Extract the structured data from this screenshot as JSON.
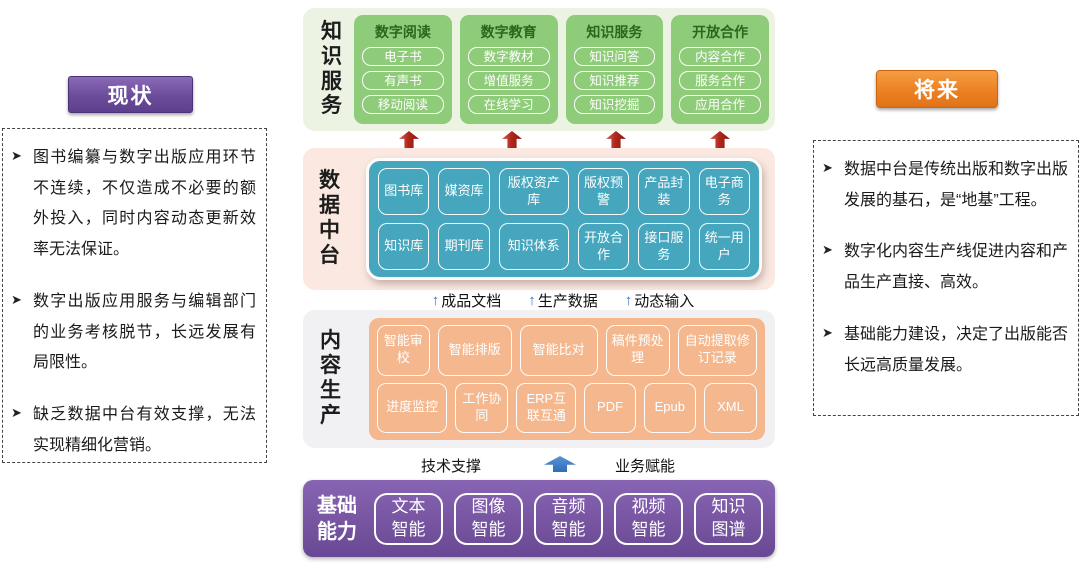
{
  "left_panel": {
    "title": "现状",
    "bullets": [
      {
        "marker": "➤",
        "text": "图书编纂与数字出版应用环节不连续，不仅造成不必要的额外投入，同时内容动态更新效率无法保证。"
      },
      {
        "marker": "➤",
        "text": "数字出版应用服务与编辑部门的业务考核脱节，长远发展有局限性。"
      },
      {
        "marker": "➤",
        "text": "缺乏数据中台有效支撑，无法实现精细化营销。"
      }
    ]
  },
  "right_panel": {
    "title": "将来",
    "bullets": [
      {
        "marker": "➤",
        "text": "数据中台是传统出版和数字出版发展的基石，是“地基”工程。"
      },
      {
        "marker": "➤",
        "text": "数字化内容生产线促进内容和产品生产直接、高效。"
      },
      {
        "marker": "➤",
        "text": "基础能力建设，决定了出版能否长远高质量发展。"
      }
    ]
  },
  "layers": {
    "knowledge_service": {
      "label": "知识服务",
      "cards": [
        {
          "title": "数字阅读",
          "items": [
            "电子书",
            "有声书",
            "移动阅读"
          ]
        },
        {
          "title": "数字教育",
          "items": [
            "数字教材",
            "增值服务",
            "在线学习"
          ]
        },
        {
          "title": "知识服务",
          "items": [
            "知识问答",
            "知识推荐",
            "知识挖掘"
          ]
        },
        {
          "title": "开放合作",
          "items": [
            "内容合作",
            "服务合作",
            "应用合作"
          ]
        }
      ]
    },
    "data_platform": {
      "label": "数据中台",
      "rows": [
        [
          "图书库",
          "媒资库",
          "版权资产库",
          "版权预警",
          "产品封装",
          "电子商务"
        ],
        [
          "知识库",
          "期刊库",
          "知识体系",
          "开放合作",
          "接口服务",
          "统一用户"
        ]
      ]
    },
    "flow": {
      "items": [
        {
          "icon": "↑",
          "label": "成品文档"
        },
        {
          "icon": "↑",
          "label": "生产数据"
        },
        {
          "icon": "↑",
          "label": "动态输入"
        }
      ]
    },
    "content_production": {
      "label": "内容生产",
      "rows": [
        [
          "智能审校",
          "智能排版",
          "智能比对",
          "稿件预处理",
          "自动提取修订记录"
        ],
        [
          "进度监控",
          "工作协同",
          "ERP互联互通",
          "PDF",
          "Epub",
          "XML"
        ]
      ]
    },
    "support": {
      "left": "技术支撑",
      "right": "业务赋能"
    },
    "basic_capability": {
      "label": "基础能力",
      "items": [
        "文本智能",
        "图像智能",
        "音频智能",
        "视频智能",
        "知识图谱"
      ]
    }
  },
  "colors": {
    "green_band": "#ecf3e3",
    "green_card": "#8fcc7a",
    "green_title": "#2c661c",
    "pink_band": "#fbe9e1",
    "teal_box": "#45a6bd",
    "gray_band": "#f1f1f3",
    "orange_box": "#f4b78e",
    "purple_band": "#75539f",
    "purple_button": "#6b4c9b",
    "orange_button": "#ec8122",
    "red_arrow": "#b0271d",
    "blue_arrow": "#4472c4",
    "fat_blue_arrow": "#2f6db8"
  }
}
